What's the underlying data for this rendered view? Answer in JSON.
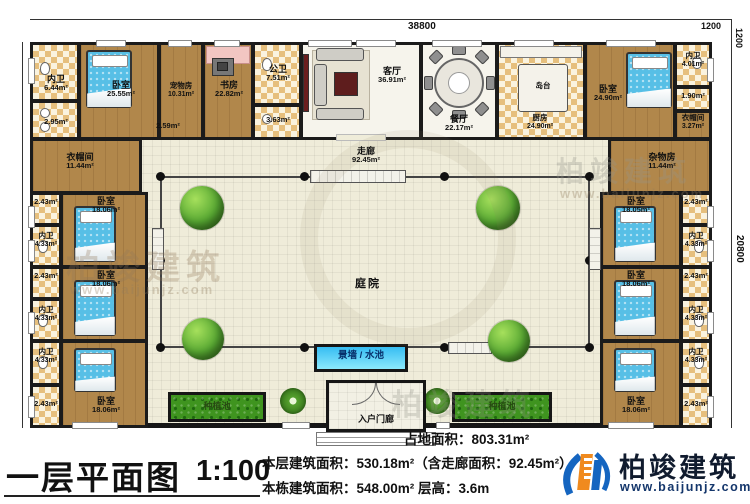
{
  "dims": {
    "top": "38800",
    "offset_h": "1200",
    "offset_v": "1200",
    "right": "20800"
  },
  "corridor": {
    "name": "走廊",
    "area": "92.45m²"
  },
  "courtyard": {
    "name": "庭院"
  },
  "features": {
    "water": "景墙 / 水池",
    "planter_left": "种植池",
    "planter_right": "种植池",
    "porch": "入户门廊"
  },
  "rooms": {
    "bath_tl": {
      "name": "内卫",
      "area": "6.44m²"
    },
    "bath_tl2": {
      "area": "2.95m²"
    },
    "bed_tl": {
      "name": "卧室",
      "area": "25.55m²"
    },
    "pet": {
      "name": "宠物房",
      "area": "10.31m²"
    },
    "hall": {
      "area": "2.59m²"
    },
    "study": {
      "name": "书房",
      "area": "22.82m²"
    },
    "pubbath": {
      "name": "公卫",
      "area": "7.51m²"
    },
    "pubbath2": {
      "area": "3.63m²"
    },
    "living": {
      "name": "客厅",
      "area": "36.91m²"
    },
    "dining": {
      "name": "餐厅",
      "area": "22.17m²"
    },
    "kitchen": {
      "name": "厨房",
      "area": "24.90m²"
    },
    "island": {
      "name": "岛台"
    },
    "bed_tr": {
      "name": "卧室",
      "area": "24.90m²"
    },
    "bath_tr": {
      "name": "内卫",
      "area": "4.01m²"
    },
    "bath_tr2": {
      "area": "1.90m²"
    },
    "closet_tr": {
      "name": "衣帽间",
      "area": "3.27m²"
    },
    "closet_l": {
      "name": "衣帽间",
      "area": "11.44m²"
    },
    "storage": {
      "name": "杂物房",
      "area": "11.44m²"
    },
    "bed_l1": {
      "name": "卧室",
      "area": "18.06m²"
    },
    "bath_l1": {
      "name": "内卫",
      "area": "4.33m²"
    },
    "niche_l1": {
      "area": "2.43m²"
    },
    "bed_l2": {
      "name": "卧室",
      "area": "18.06m²"
    },
    "bath_l2": {
      "name": "内卫",
      "area": "4.33m²"
    },
    "niche_l2": {
      "area": "2.43m²"
    },
    "bed_l3": {
      "name": "卧室",
      "area": "18.06m²"
    },
    "bath_l3": {
      "name": "内卫",
      "area": "4.33m²"
    },
    "niche_l3": {
      "area": "2.43m²"
    },
    "bed_r1": {
      "name": "卧室",
      "area": "18.05m²"
    },
    "bath_r1": {
      "name": "内卫",
      "area": "4.33m²"
    },
    "niche_r1": {
      "area": "2.43m²"
    },
    "bed_r2": {
      "name": "卧室",
      "area": "18.06m²"
    },
    "bath_r2": {
      "name": "内卫",
      "area": "4.33m²"
    },
    "niche_r2": {
      "area": "2.43m²"
    },
    "bed_r3": {
      "name": "卧室",
      "area": "18.06m²"
    },
    "bath_r3": {
      "name": "内卫",
      "area": "4.33m²"
    },
    "niche_r3": {
      "area": "2.43m²"
    }
  },
  "title_block": {
    "title": "一层平面图",
    "scale": "1:100",
    "land": "占地面积：803.31m²",
    "floor": "本层建筑面积：530.18m²（含走廊面积：92.45m²）",
    "building": "本栋建筑面积：548.00m²  层高：3.6m"
  },
  "logo": {
    "name": "柏竣建筑",
    "site": "www.baijunjz.com"
  },
  "watermark": {
    "text": "柏竣建筑",
    "site": "www.baijunjz.com"
  },
  "colors": {
    "wood": "#b1874b",
    "tile": "#e6bf7d",
    "water": "#36bdf2",
    "planter": "#3f941f",
    "logo_blue": "#1565c0",
    "logo_orange": "#f08a1e"
  }
}
